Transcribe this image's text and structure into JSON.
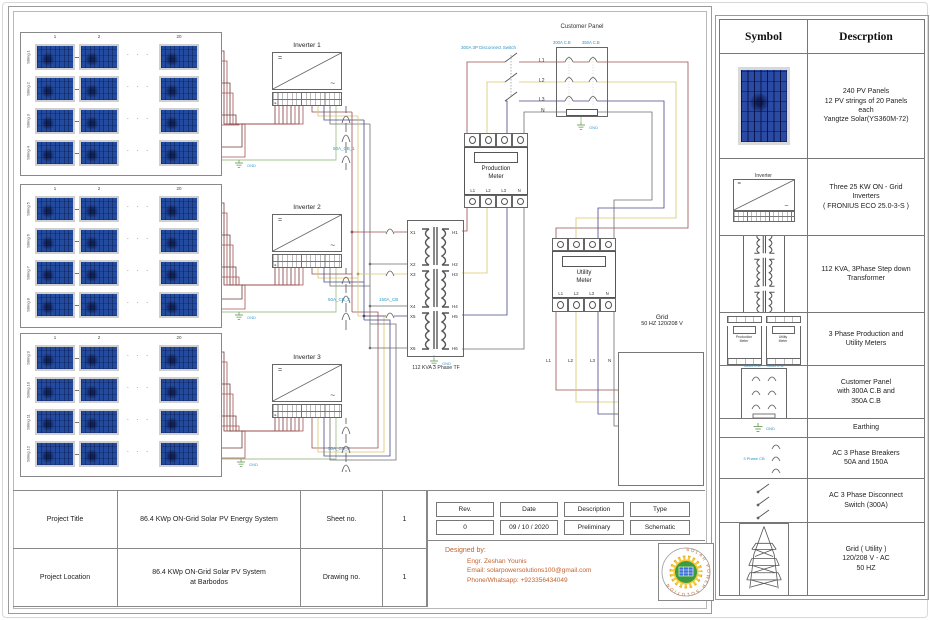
{
  "diagram": {
    "dots": "· · ·",
    "gnd": "GND",
    "pv_groups": [
      {
        "cols": [
          "1",
          "2",
          "20"
        ],
        "strings": [
          "String 1",
          "String 2",
          "String 3",
          "String 4"
        ]
      },
      {
        "cols": [
          "1",
          "2",
          "20"
        ],
        "strings": [
          "String 5",
          "String 6",
          "String 7",
          "String 8"
        ]
      },
      {
        "cols": [
          "1",
          "2",
          "20"
        ],
        "strings": [
          "String 9",
          "String 10",
          "String 11",
          "String 12"
        ]
      }
    ],
    "inverters": [
      {
        "label": "Inverter 1",
        "dc": "=",
        "ac": "~",
        "breaker": "50A_CB_1"
      },
      {
        "label": "Inverter 2",
        "dc": "=",
        "ac": "~",
        "breaker": "50A_CB_2"
      },
      {
        "label": "Inverter 3",
        "dc": "=",
        "ac": "~",
        "breaker": "50A_CB_3"
      }
    ],
    "main_breaker": "150A_CB",
    "transformer": {
      "label": "112 KVA   3  Phase TF",
      "x": [
        "X1",
        "X2",
        "X3",
        "X4",
        "X5",
        "X6"
      ],
      "h": [
        "H1",
        "H2",
        "H3",
        "H4",
        "H5",
        "H6"
      ]
    },
    "production_meter": {
      "name": "Production\nMeter",
      "lines": [
        "L1",
        "L2",
        "L3",
        "N"
      ]
    },
    "utility_meter": {
      "name": "Utility\nMeter",
      "lines": [
        "L1",
        "L2",
        "L3",
        "N"
      ],
      "out_lines": [
        "L1",
        "L2",
        "L3",
        "N"
      ]
    },
    "disconnect_label": "300A 3P Disconnect Switch",
    "switch_lines": [
      "L1",
      "L2",
      "L3",
      "N"
    ],
    "panel": {
      "title": "Customer\nPanel",
      "cb_left": "300A C.B",
      "cb_right": "350A C.B"
    },
    "grid": {
      "name": "Grid",
      "spec": "50 HZ   120/208 V"
    }
  },
  "legend": {
    "header_symbol": "Symbol",
    "header_desc": "Descrption",
    "rows": [
      {
        "desc": "240 PV Panels\n12 PV strings of 20 Panels\neach\nYangtze Solar(YS360M-72)"
      },
      {
        "caption": "Inverter",
        "desc": "Three 25 KW ON - Grid\nInverters\n( FRONIUS ECO 25.0-3-S )"
      },
      {
        "desc": "112 KVA, 3Phase Step down\nTransformer"
      },
      {
        "caption_a": "Production\nMeter",
        "caption_b": "Utility\nMeter",
        "desc": "3 Phase Production and\nUtility Meters"
      },
      {
        "caption_a": "300A C.B",
        "caption_b": "350A C.B",
        "desc": "Customer Panel\nwith 300A C.B and\n350A C.B"
      },
      {
        "caption": "GND",
        "desc": "Earthing"
      },
      {
        "caption": "3 Phase CB",
        "desc": "AC 3 Phase Breakers\n50A and 150A"
      },
      {
        "desc": "AC 3 Phase Disconnect\nSwitch (300A)"
      },
      {
        "desc": "Grid ( Utility )\n120/208 V - AC\n50 HZ"
      }
    ]
  },
  "titleblock": {
    "title_label": "Project Title",
    "title": "86.4 KWp ON-Grid Solar PV Energy System",
    "sheet_label": "Sheet no.",
    "sheet": "1",
    "location_label": "Project Location",
    "location": "86.4 KWp ON-Grid Solar PV System\nat Barbodos",
    "drawing_label": "Drawing no.",
    "drawing": "1"
  },
  "revision": {
    "headers": [
      "Rev.",
      "Date",
      "Description",
      "Type"
    ],
    "values": [
      "0",
      "09 / 10 / 2020",
      "Preliminary",
      "Schematic"
    ]
  },
  "designer": {
    "heading": "Designed by:",
    "name": "Engr. Zeshan Younis",
    "email": "Email: solarpowersolutions100@gmail.com",
    "phone": "Phone/Whatsapp: +923356434049"
  },
  "colors": {
    "l1_red": "#9a4f4f",
    "l2_yellow": "#d6c66a",
    "l3_navy": "#474787",
    "neutral_gray": "#6f6f6f",
    "earth_green": "#a3c293",
    "dc_pos": "#a85252",
    "dc_neg": "#6e3c3c",
    "label_blue": "#2f96c8",
    "panel_blue": "#224a9e",
    "designer_orange": "#c4622d"
  }
}
